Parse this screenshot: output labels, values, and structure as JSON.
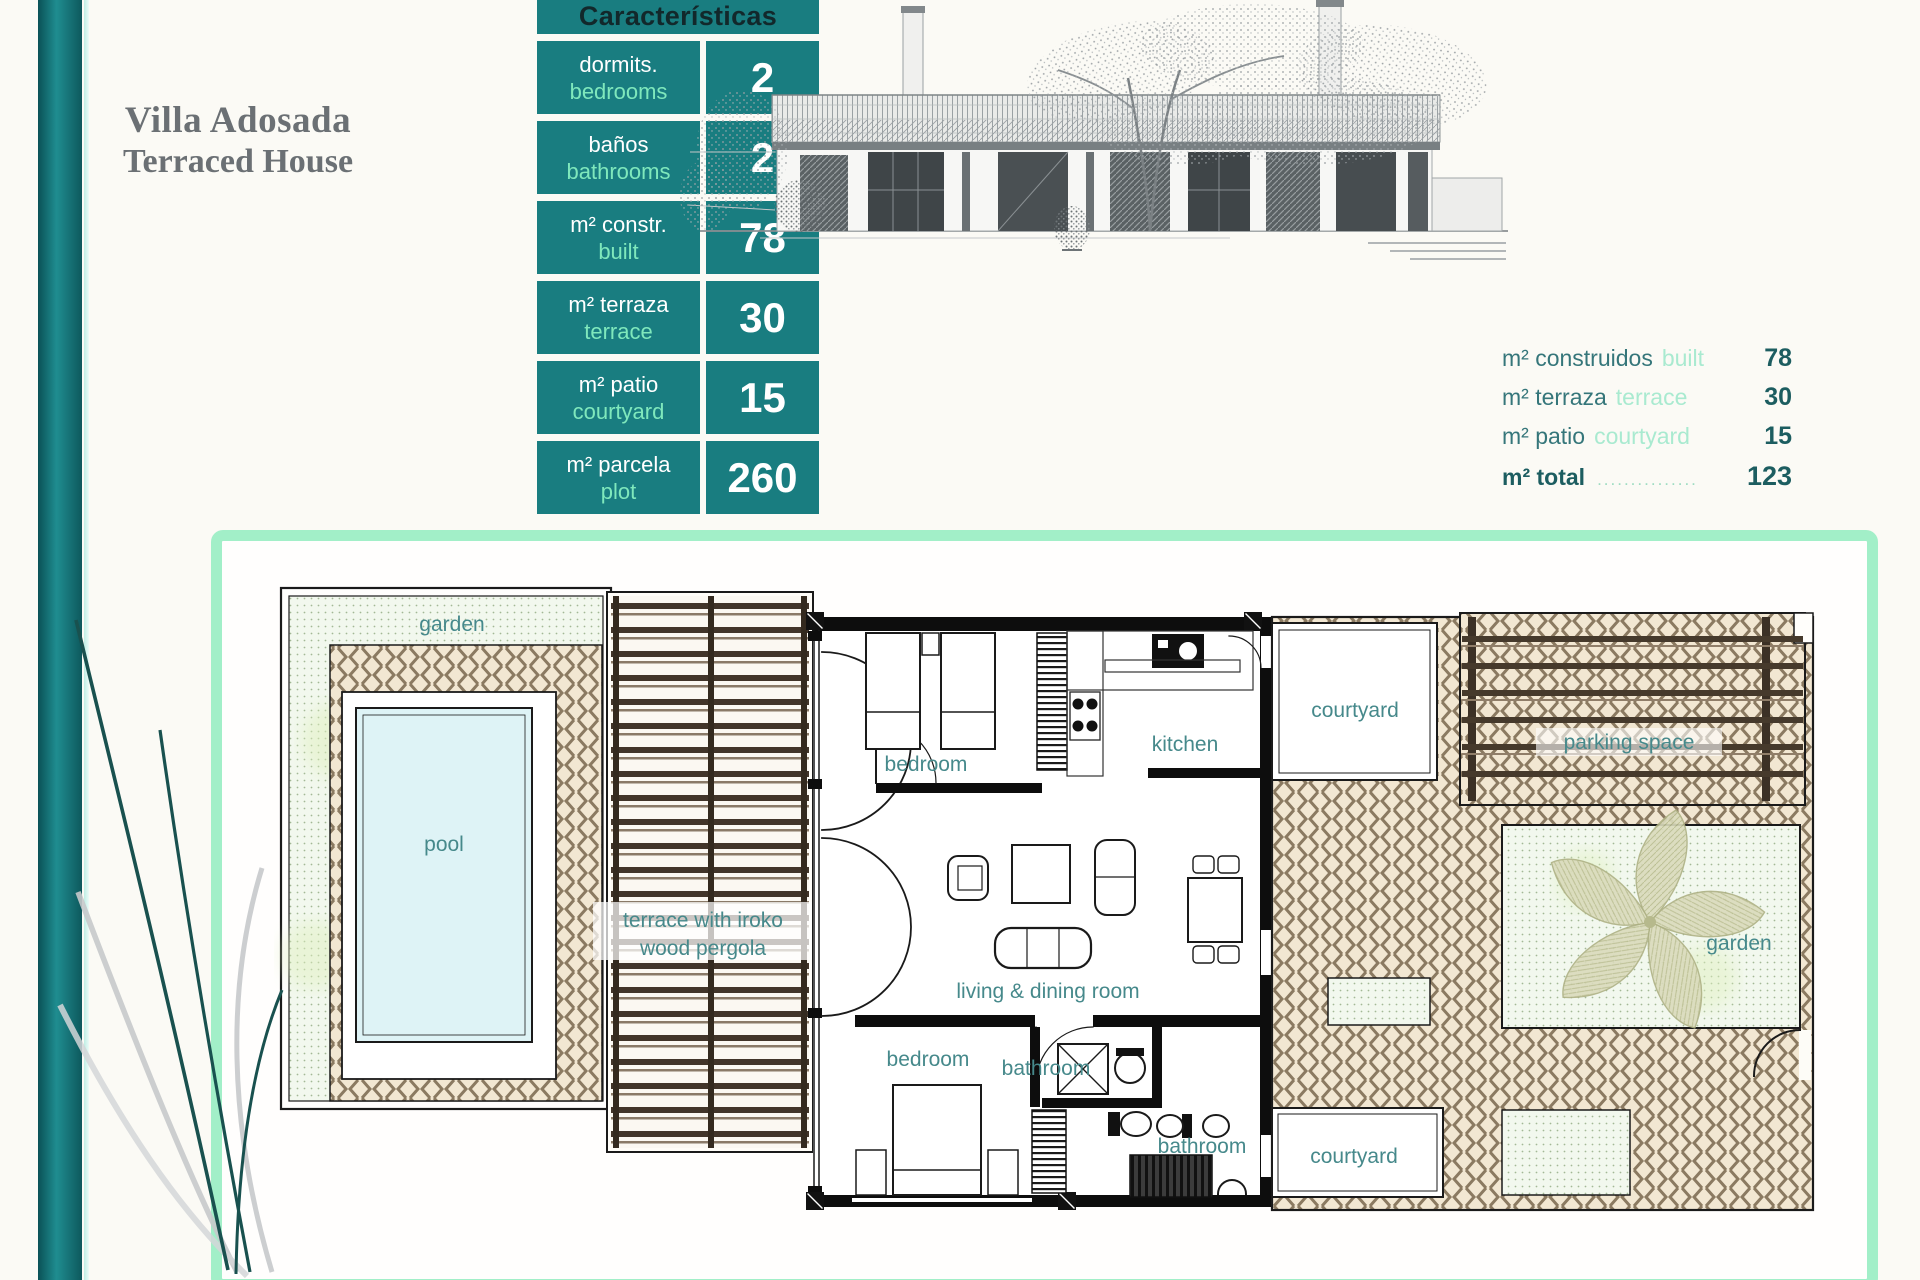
{
  "title": {
    "line1": "Villa Adosada",
    "line2": "Terraced House"
  },
  "features_table": {
    "header": "Características",
    "rows": [
      {
        "label_es": "dormits.",
        "label_en": "bedrooms",
        "value": "2"
      },
      {
        "label_es": "baños",
        "label_en": "bathrooms",
        "value": "2"
      },
      {
        "label_es": "m² constr.",
        "label_en": "built",
        "value": "78"
      },
      {
        "label_es": "m² terraza",
        "label_en": "terrace",
        "value": "30"
      },
      {
        "label_es": "m² patio",
        "label_en": "courtyard",
        "value": "15"
      },
      {
        "label_es": "m² parcela",
        "label_en": "plot",
        "value": "260"
      }
    ]
  },
  "area_summary": {
    "rows": [
      {
        "label_es": "m² construidos",
        "label_en": "built",
        "value": "78"
      },
      {
        "label_es": "m² terraza",
        "label_en": "terrace",
        "value": "30"
      },
      {
        "label_es": "m² patio",
        "label_en": "courtyard",
        "value": "15"
      }
    ],
    "total": {
      "label_es": "m² total",
      "leader": "...............",
      "value": "123"
    }
  },
  "floor_plan": {
    "labels": {
      "garden_left": "garden",
      "pool": "pool",
      "terrace_line1": "terrace with iroko",
      "terrace_line2": "wood pergola",
      "bedroom_top": "bedroom",
      "kitchen": "kitchen",
      "courtyard_top": "courtyard",
      "parking": "parking space",
      "garden_right": "garden",
      "living": "living & dining room",
      "bedroom_bottom": "bedroom",
      "bathroom_1": "bathroom",
      "bathroom_2": "bathroom",
      "courtyard_bottom": "courtyard"
    }
  },
  "colors": {
    "teal_cell": "#197d80",
    "mint_border": "#a2efc8",
    "plan_label_text": "#46898b",
    "summary_dark": "#2e6f72",
    "summary_light": "#a9ead0"
  }
}
